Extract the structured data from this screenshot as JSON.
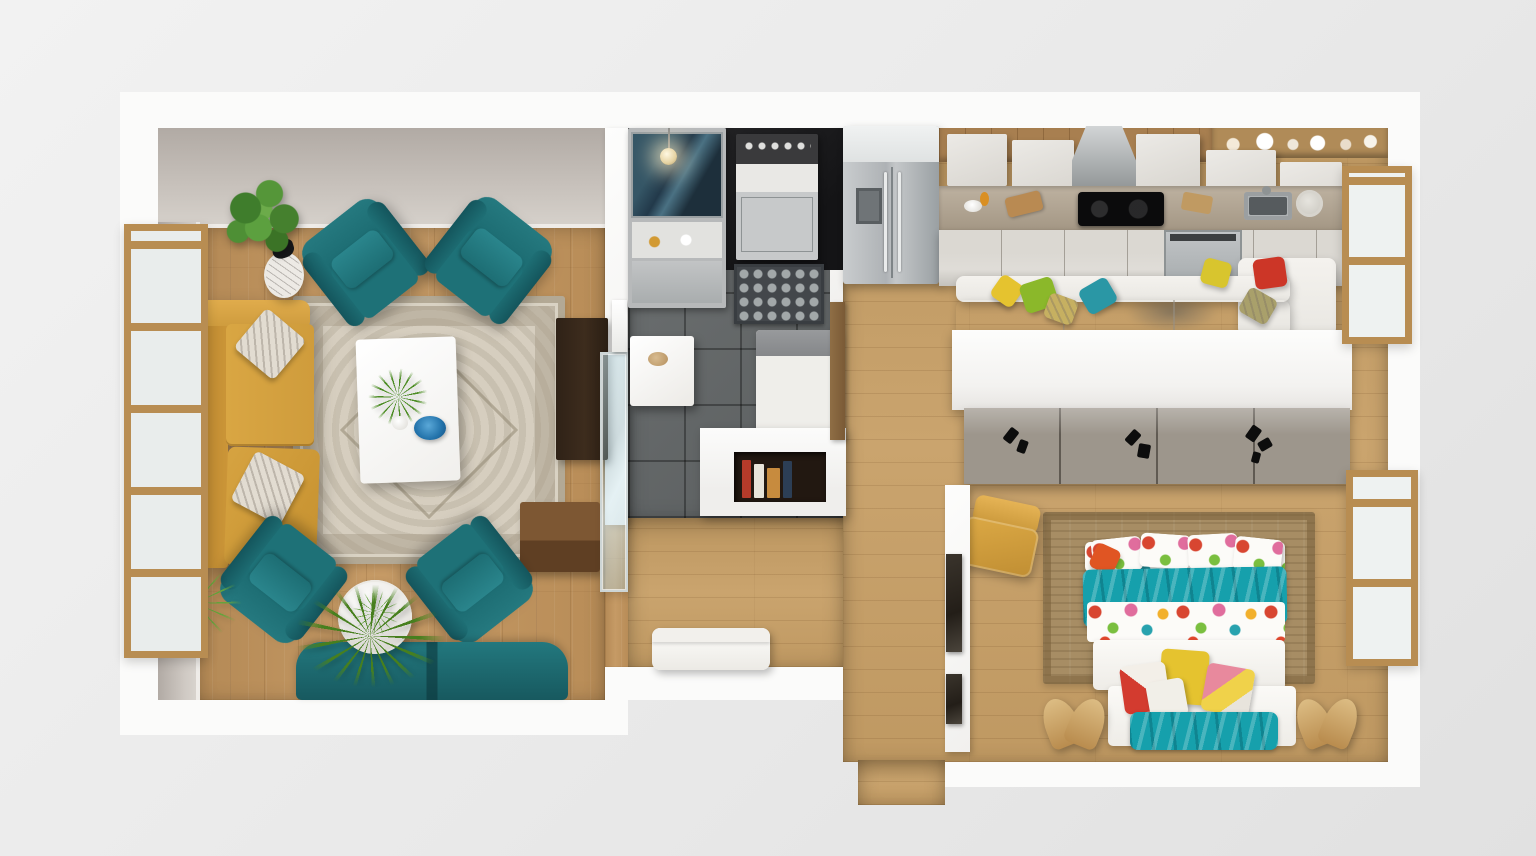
{
  "scene": {
    "type": "3d-rendered floor plan",
    "view": "top-down dollhouse render",
    "description": "Photorealistic top-down render of a modern one-bedroom apartment with living room, utility kitchenette, open kitchen with lounge, hallway and bedroom",
    "background": "#e9e9e9",
    "walls": "#fbfbfa"
  },
  "palette": {
    "living_wood": "#c2945c",
    "hall_wood": "#c79f66",
    "tile": "#65696a",
    "accent_wall": "#1b1b1d",
    "teal_seat": "#19676d",
    "teal_dark": "#14555c",
    "mustard": "#d49f3e",
    "rug_base": "#d6cebf",
    "rug_border": "#b3a995",
    "jute": "#a78d64",
    "bed_teal": "#16a0ac",
    "pillow_yellow": "#e5c32f",
    "pillow_green": "#8bb82a",
    "pillow_teal": "#2a97a5",
    "pillow_red": "#cc3627",
    "wardrobe": "#9d968c",
    "cabinet": "#dbd8d2",
    "counter": "#b2a490",
    "stainless": "#b5b8ba",
    "wood_frame": "#b88d52",
    "walls": "#fbfbfa"
  },
  "rooms": {
    "living_room": {
      "name": "Living room",
      "items": [
        "tall wood-framed window",
        "mustard leather sofa with patterned pillows",
        "four teal armchairs",
        "teal settee",
        "white coffee table with plant and blue glass dish",
        "ornate beige area rug",
        "round white side table",
        "marble accent table with black sculpture",
        "potted fern",
        "spiky floor plant",
        "grass plant",
        "dark wood media console",
        "walnut cube side table",
        "sliding glass door"
      ]
    },
    "kitchenette": {
      "name": "Utility kitchenette",
      "items": [
        "black accent wall",
        "compact steel kitchen unit",
        "glass display cabinet",
        "brass pendant lamp",
        "patterned tile mat",
        "grey tile floor",
        "white breakfast table",
        "white corner bench",
        "half wall with book niche",
        "wood door"
      ]
    },
    "kitchen": {
      "name": "Open kitchen",
      "items": [
        "stainless french-door refrigerator",
        "white upper cabinets",
        "stainless range hood",
        "black cooktop",
        "inset sink with faucet",
        "leaning plate",
        "open shelf with dishes",
        "white drawer cabinets",
        "stainless dishwasher",
        "wood counter strip"
      ]
    },
    "lounge": {
      "name": "Lounge nook",
      "items": [
        "white sectional sofa with chaise",
        "yellow, green, teal, red and patterned throw pillows",
        "grey rug"
      ]
    },
    "hallway": {
      "name": "Hallway",
      "items": [
        "white lounge bench",
        "two dark framed pictures",
        "open entry threshold"
      ]
    },
    "bedroom": {
      "name": "Bedroom",
      "items": [
        "wardrobe divider with black handles",
        "double bed with floral duvet and teal throws",
        "jute area rug",
        "white foot bench with yellow, red and pink pillows",
        "two wooden butterfly chairs",
        "mustard accent chair",
        "wood-framed window"
      ]
    }
  }
}
